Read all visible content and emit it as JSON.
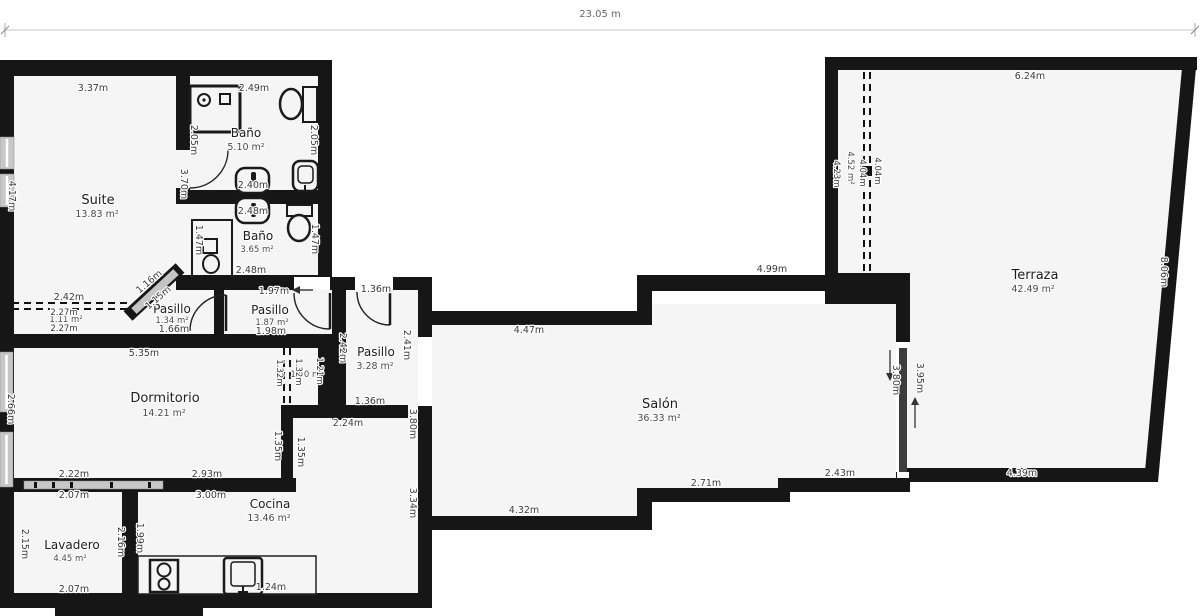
{
  "meta": {
    "total_width_label": "23.05 m"
  },
  "rooms": {
    "suite": {
      "name": "Suite",
      "area": "13.83 m²"
    },
    "bano1": {
      "name": "Baño",
      "area": "5.10 m²"
    },
    "bano2": {
      "name": "Baño",
      "area": "3.65 m²"
    },
    "pasillo1": {
      "name": "Pasillo",
      "area": "1.34 m²"
    },
    "pasillo2": {
      "name": "Pasillo",
      "area": "1.87 m²"
    },
    "pasillo3": {
      "name": "Pasillo",
      "area": "3.28 m²"
    },
    "closet1": {
      "area": "1.11 m²"
    },
    "closet2": {
      "area": "1.00 m²"
    },
    "strip": {
      "area": "4.52 m²"
    },
    "dormitorio": {
      "name": "Dormitorio",
      "area": "14.21 m²"
    },
    "lavadero": {
      "name": "Lavadero",
      "area": "4.45 m²"
    },
    "cocina": {
      "name": "Cocina",
      "area": "13.46 m²"
    },
    "salon": {
      "name": "Salón",
      "area": "36.33 m²"
    },
    "terraza": {
      "name": "Terraza",
      "area": "42.49 m²"
    }
  },
  "dims": {
    "suite_top": "3.37m",
    "suite_left": "4.17m",
    "bano1_top": "2.49m",
    "bano1_left": "2.05m",
    "bano1_right": "2.05m",
    "bano1_tub": "2.40m",
    "suite_bano_wall": "3.70m",
    "bano2_tub_top": "2.48m",
    "bano2_left": "1.47m",
    "bano2_right": "1.47m",
    "bano2_bottom": "2.48m",
    "hall_top": "1.97m",
    "hall_diag_a": "1.16m",
    "hall_diag_b": "1.15m",
    "opening_suite": "2.42m",
    "closet1_top": "2.27m",
    "closet1_bottom": "2.27m",
    "pasillo1_bottom": "1.66m",
    "pasillo2_bottom": "1.98m",
    "pasillo3_top": "1.36m",
    "pasillo3_left": "2.42m",
    "pasillo3_right": "2.41m",
    "pasillo3_bottom": "1.36m",
    "shaft_top": "2.24m",
    "closet2_left_a": "1.32m",
    "closet2_left_b": "1.32m",
    "closet2_right": "1.21m",
    "dorm_top": "5.35m",
    "dorm_left": "2.66m",
    "dorm_bottom_a": "2.22m",
    "dorm_bottom_b": "2.93m",
    "dorm_right_a": "1.35m",
    "dorm_right_b": "1.35m",
    "lav_top": "2.07m",
    "lav_left": "2.15m",
    "lav_right": "2.16m",
    "lav_bottom": "2.07m",
    "cocina_left": "1.99m",
    "cocina_top": "3.00m",
    "cocina_right": "3.34m",
    "cocina_sink": "1.24m",
    "salon_wall_left": "3.80m",
    "salon_top_a": "4.47m",
    "salon_top_b": "4.99m",
    "salon_bottom_a": "4.32m",
    "salon_bottom_b": "2.71m",
    "salon_bottom_c": "2.43m",
    "salon_door": "3.80m",
    "salon_door_wall": "3.95m",
    "terr_top": "6.24m",
    "terr_right": "8.06m",
    "terr_bottom": "4.39m",
    "strip_left": "4.23m",
    "strip_dash_a": "4.04m",
    "strip_dash_b": "4.04m"
  },
  "colors": {
    "wall": "#161616",
    "room_fill": "#f5f5f5",
    "window": "#c7c7c7",
    "dim_text": "#3a3a3a"
  }
}
